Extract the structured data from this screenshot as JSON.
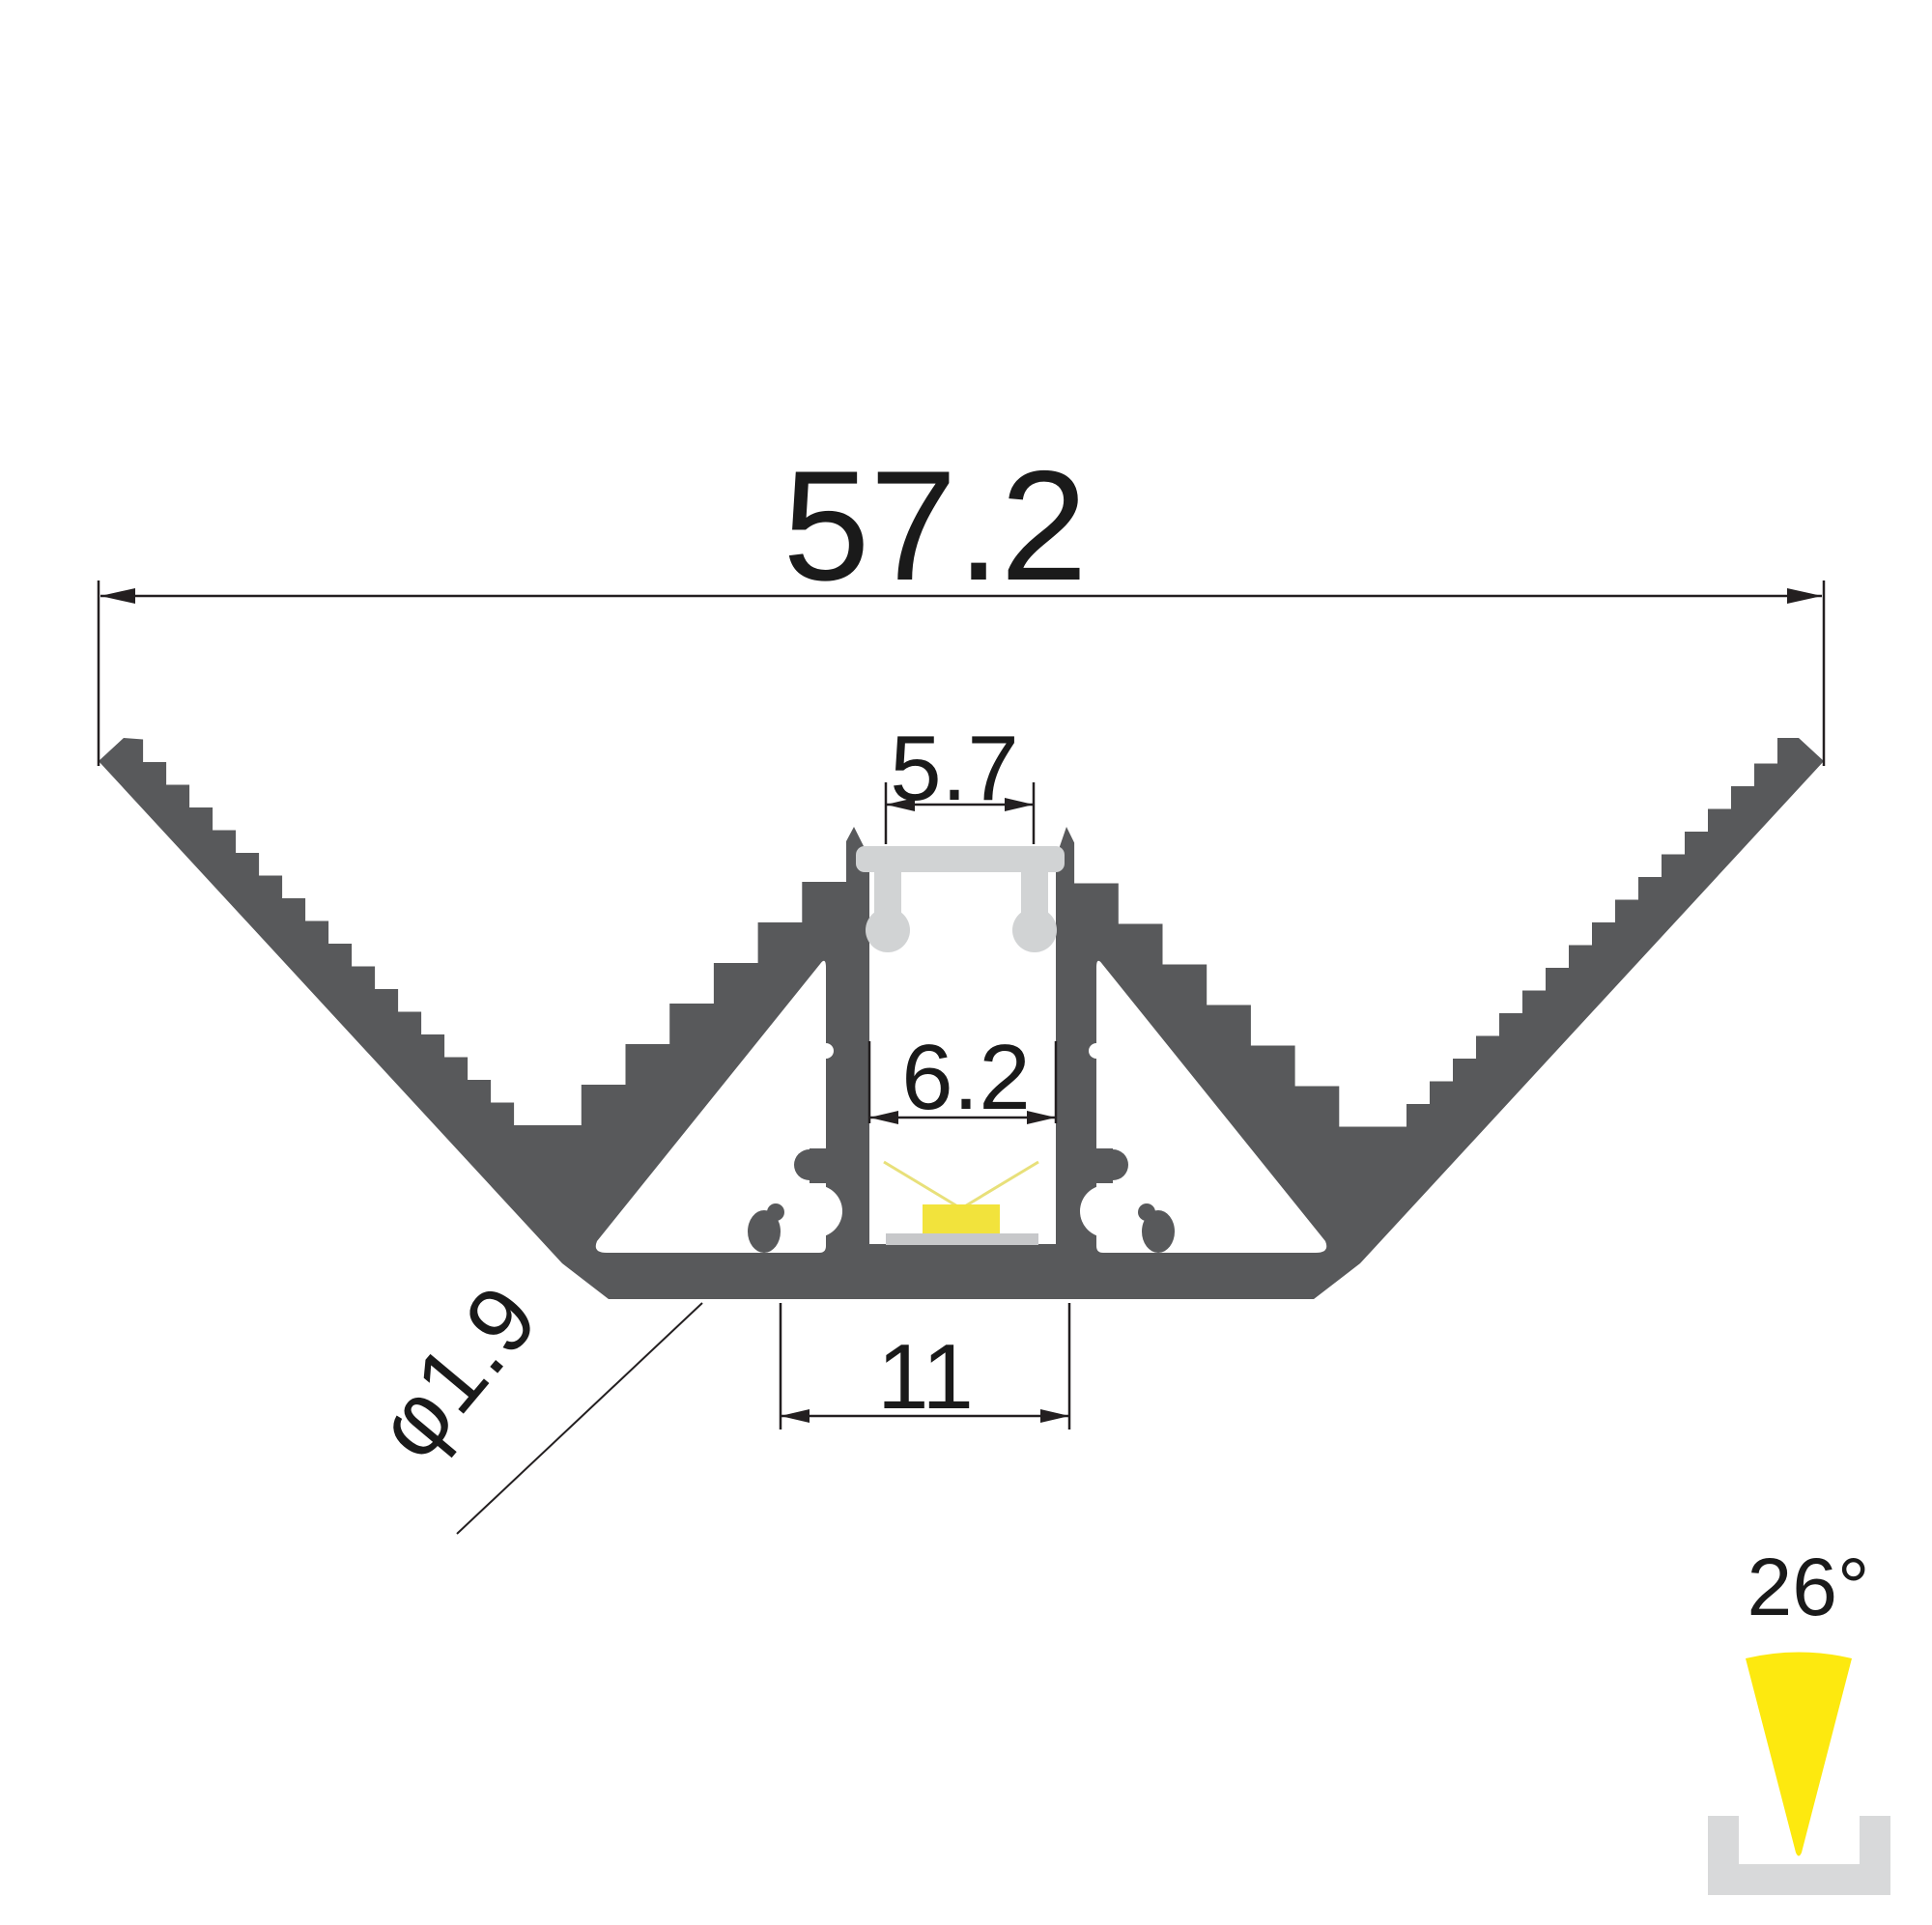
{
  "drawing": {
    "title": "led-profile-cross-section",
    "dimensions": {
      "overall_width": "57.2",
      "slot_opening": "5.7",
      "cavity_width": "6.2",
      "base_width": "11",
      "hole_diameter": "φ1.9",
      "beam_angle": "26°"
    },
    "colors": {
      "profile": "#58595b",
      "diffuser": "#d1d3d4",
      "pcb": "#c7c8ca",
      "led": "#f2e33c",
      "ray": "#e8e07a",
      "cone": "#fde90f",
      "channel_icon": "#d8d9da",
      "line": "#231f20"
    }
  }
}
